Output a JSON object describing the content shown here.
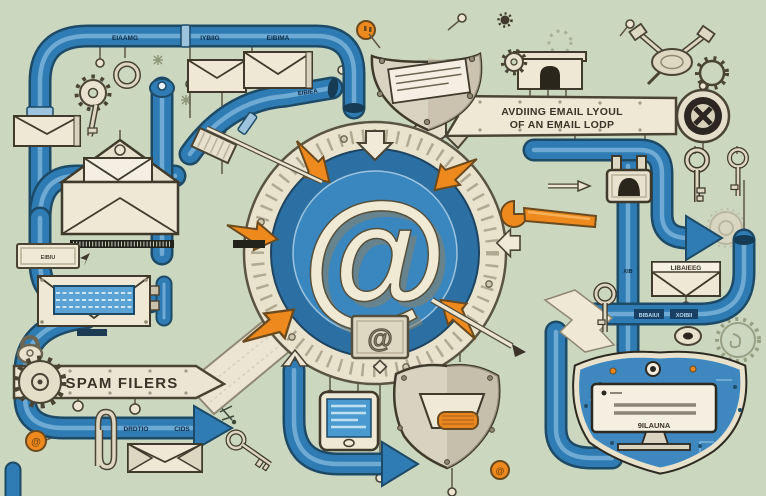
{
  "colors": {
    "background": "#ccd7c0",
    "pipe_blue": "#2f7cb4",
    "orange": "#ee8a1d",
    "cream": "#efe8d5",
    "ring_blue": "#2e74a8",
    "outline": "#3f3a2b"
  },
  "center": {
    "at_symbol": "@",
    "badge_symbol": "@"
  },
  "banners": {
    "audit": {
      "line1": "AVDIING EMAIL LYOUL",
      "line2": "OF AN EMAIL LODP"
    },
    "spam": {
      "label": "SPAM FILERS"
    }
  },
  "pipe_labels": {
    "top": [
      "EIAAMG",
      "IYBIIG",
      "EIBIMA"
    ],
    "elbow": "EIBIEA",
    "right_horizontal": [
      "BIBAIUI",
      "XOIBII"
    ],
    "right_vertical": "XIB",
    "bottom_arrow": [
      "DRDTIO",
      "CIDS"
    ]
  },
  "plates": {
    "left_button": "EIBIU"
  },
  "envelopes": {
    "right_label": "LIBAIEEG"
  },
  "shield_monitor": {
    "label": "9ILAUNA"
  },
  "coins": {
    "left": "@",
    "bottom": "@"
  }
}
